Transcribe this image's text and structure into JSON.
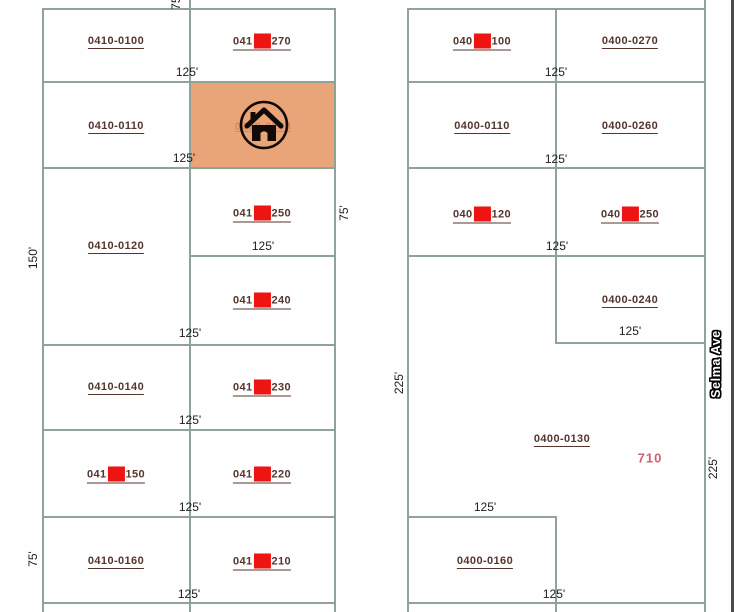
{
  "colors": {
    "boundary_line": "#8fa396",
    "street_edge": "#4b4b4b",
    "parcel_text": "#54362e",
    "dimension_text": "#1c1c1c",
    "marker_red": "#ee1411",
    "highlight_fill": "#e9a577",
    "address_text": "#cf6170",
    "street_text_fill": "#ffffff"
  },
  "map": {
    "parcels": [
      {
        "id": "0410-0100",
        "x": 116,
        "y": 42,
        "marker": false
      },
      {
        "id": "0410-0270",
        "x": 262,
        "y": 42,
        "marker": true
      },
      {
        "id": "0410-0110",
        "x": 116,
        "y": 127,
        "marker": false
      },
      {
        "id": "0410-0120",
        "x": 116,
        "y": 247,
        "marker": false
      },
      {
        "id": "0410-0250",
        "x": 262,
        "y": 214,
        "marker": true
      },
      {
        "id": "0410-0240",
        "x": 262,
        "y": 301,
        "marker": true
      },
      {
        "id": "0410-0140",
        "x": 116,
        "y": 388,
        "marker": false
      },
      {
        "id": "0410-0230",
        "x": 262,
        "y": 388,
        "marker": true
      },
      {
        "id": "0410-0150",
        "x": 116,
        "y": 475,
        "marker": true
      },
      {
        "id": "0410-0220",
        "x": 262,
        "y": 475,
        "marker": true
      },
      {
        "id": "0410-0160",
        "x": 116,
        "y": 562,
        "marker": false
      },
      {
        "id": "0410-0210",
        "x": 262,
        "y": 562,
        "marker": true
      },
      {
        "id": "0400-0100",
        "x": 482,
        "y": 42,
        "marker": true
      },
      {
        "id": "0400-0270",
        "x": 630,
        "y": 42,
        "marker": false
      },
      {
        "id": "0400-0110",
        "x": 482,
        "y": 127,
        "marker": false
      },
      {
        "id": "0400-0260",
        "x": 630,
        "y": 127,
        "marker": false
      },
      {
        "id": "0400-0120",
        "x": 482,
        "y": 215,
        "marker": true
      },
      {
        "id": "0400-0250",
        "x": 630,
        "y": 215,
        "marker": true
      },
      {
        "id": "0400-0240",
        "x": 630,
        "y": 301,
        "marker": false
      },
      {
        "id": "0400-0130",
        "x": 562,
        "y": 440,
        "marker": false
      },
      {
        "id": "0400-0160",
        "x": 485,
        "y": 562,
        "marker": false
      }
    ],
    "dimensions": [
      {
        "text": "125'",
        "x": 187,
        "y": 72,
        "rot": false
      },
      {
        "text": "125'",
        "x": 184,
        "y": 158,
        "rot": false
      },
      {
        "text": "125'",
        "x": 263,
        "y": 246,
        "rot": false
      },
      {
        "text": "125'",
        "x": 190,
        "y": 333,
        "rot": false
      },
      {
        "text": "125'",
        "x": 190,
        "y": 420,
        "rot": false
      },
      {
        "text": "125'",
        "x": 190,
        "y": 507,
        "rot": false
      },
      {
        "text": "125'",
        "x": 189,
        "y": 594,
        "rot": false
      },
      {
        "text": "125'",
        "x": 556,
        "y": 72,
        "rot": false
      },
      {
        "text": "125'",
        "x": 556,
        "y": 159,
        "rot": false
      },
      {
        "text": "125'",
        "x": 557,
        "y": 246,
        "rot": false
      },
      {
        "text": "125'",
        "x": 630,
        "y": 331,
        "rot": false
      },
      {
        "text": "125'",
        "x": 485,
        "y": 507,
        "rot": false
      },
      {
        "text": "125'",
        "x": 554,
        "y": 594,
        "rot": false
      },
      {
        "text": "75'",
        "x": 176,
        "y": 2,
        "rot": true
      },
      {
        "text": "150'",
        "x": 33,
        "y": 258,
        "rot": true
      },
      {
        "text": "75'",
        "x": 344,
        "y": 213,
        "rot": true
      },
      {
        "text": "75'",
        "x": 33,
        "y": 559,
        "rot": true
      },
      {
        "text": "225'",
        "x": 399,
        "y": 383,
        "rot": true
      },
      {
        "text": "225'",
        "x": 713,
        "y": 468,
        "rot": true
      }
    ],
    "street": {
      "name": "Selma Ave"
    },
    "address": {
      "text": "710"
    },
    "highlight": {
      "faint_id": "0410-0260"
    }
  }
}
